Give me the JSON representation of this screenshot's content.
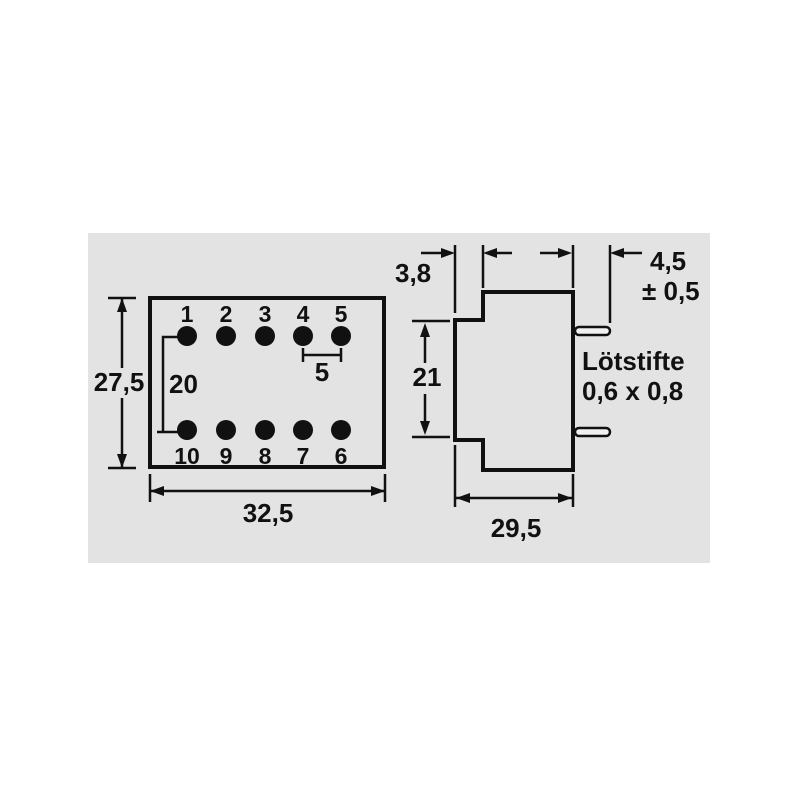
{
  "panel": {
    "background_color": "#e3e3e3",
    "line_color": "#111111"
  },
  "left_view": {
    "description": "bottom/top pin layout view",
    "pin_numbers_top": [
      "1",
      "2",
      "3",
      "4",
      "5"
    ],
    "pin_numbers_bottom": [
      "10",
      "9",
      "8",
      "7",
      "6"
    ],
    "dim_height": "27,5",
    "dim_width": "32,5",
    "dim_row_spacing": "20",
    "dim_pin_pitch": "5"
  },
  "right_view": {
    "description": "side profile view",
    "dim_flange_offset": "3,8",
    "dim_body_height": "21",
    "dim_depth": "29,5",
    "dim_pin_length": "4,5",
    "dim_pin_length_tolerance": "± 0,5",
    "pin_note_line1": "Lötstifte",
    "pin_note_line2": "0,6 x 0,8"
  }
}
